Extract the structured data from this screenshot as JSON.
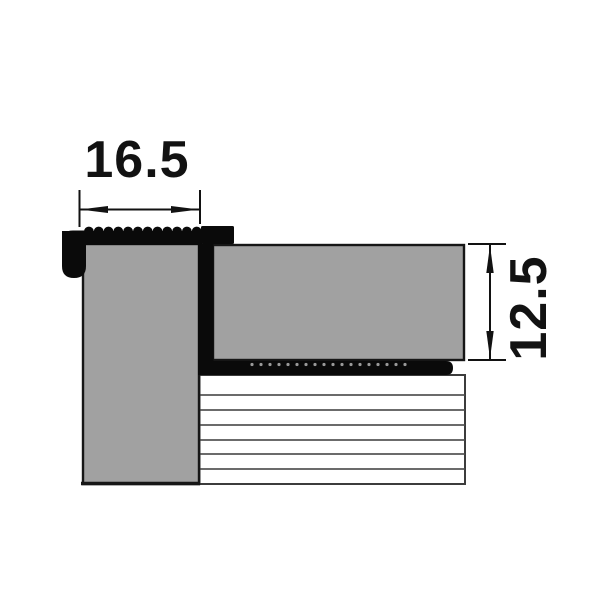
{
  "drawing": {
    "width_dimension": "16.5",
    "height_dimension": "12.5"
  },
  "colors": {
    "background": "#ffffff",
    "profile": "#0a0a0a",
    "tile-fill": "#a1a1a1",
    "tile-outline": "#161616",
    "dimension": "#121212",
    "hatch-border": "#3c3c3c",
    "hatch-line": "#565656",
    "serration-dot": "#9a9a9a"
  }
}
